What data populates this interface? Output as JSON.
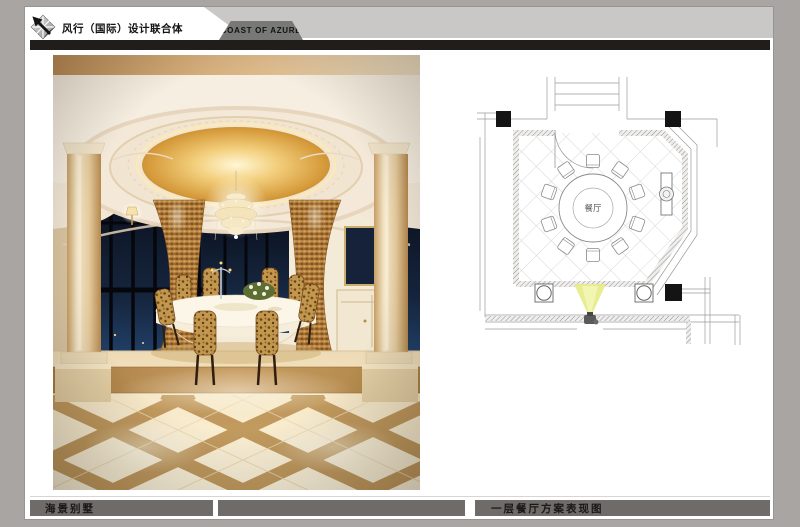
{
  "header": {
    "company_name": "风行（国际）设计联合体",
    "brand_name": "COAST OF AZURE"
  },
  "footer": {
    "project_name": "海景别墅",
    "drawing_title": "一层餐厅方案表现图"
  },
  "floor_plan": {
    "room_label": "餐厅"
  },
  "colors": {
    "page_background": "#a8a5a2",
    "sheet": "#ffffff",
    "header_rule": "#211d1a",
    "band_light": "#c9c8c6",
    "band_dark": "#787876",
    "footer_bar": "#6e6b68",
    "plan_line": "#8a8a8a",
    "camera_cone": "#e6ec8a",
    "dome_gold": "#e7b457"
  }
}
